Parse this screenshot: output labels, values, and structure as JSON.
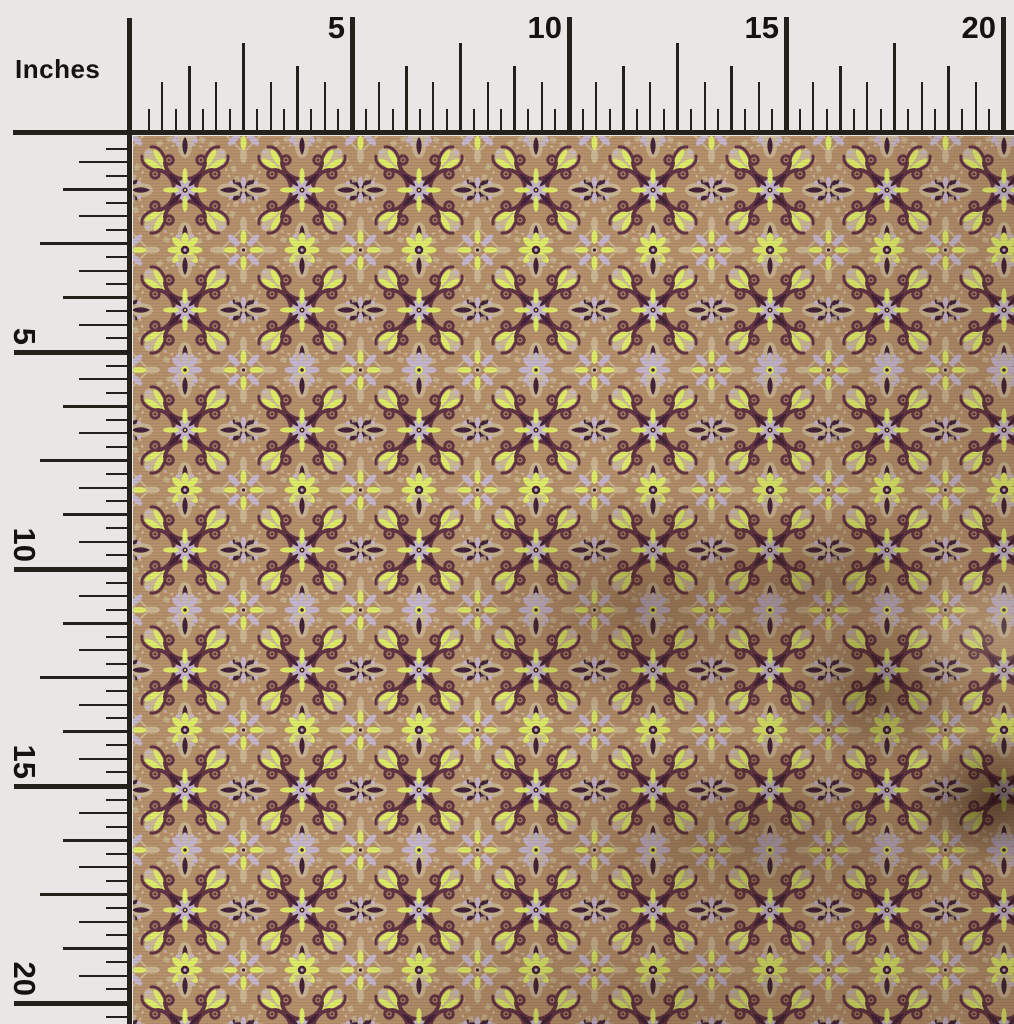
{
  "ruler": {
    "units_label": "Inches",
    "top_labels": [
      "5",
      "10",
      "15",
      "20"
    ],
    "left_labels": [
      "5",
      "10",
      "15",
      "20"
    ],
    "colors": {
      "rulerBg": "#e8e7e5",
      "rulerLine": "#24211c",
      "numColor": "#151310"
    }
  },
  "fabric": {
    "colors": {
      "base": "#b28d68",
      "scroll": "#5e3040",
      "plum": "#3f1f35",
      "lime": "#dcea66",
      "lavender": "#c3b3c9",
      "beige": "#cbb996",
      "beigeL": "#ddd2b4"
    }
  }
}
